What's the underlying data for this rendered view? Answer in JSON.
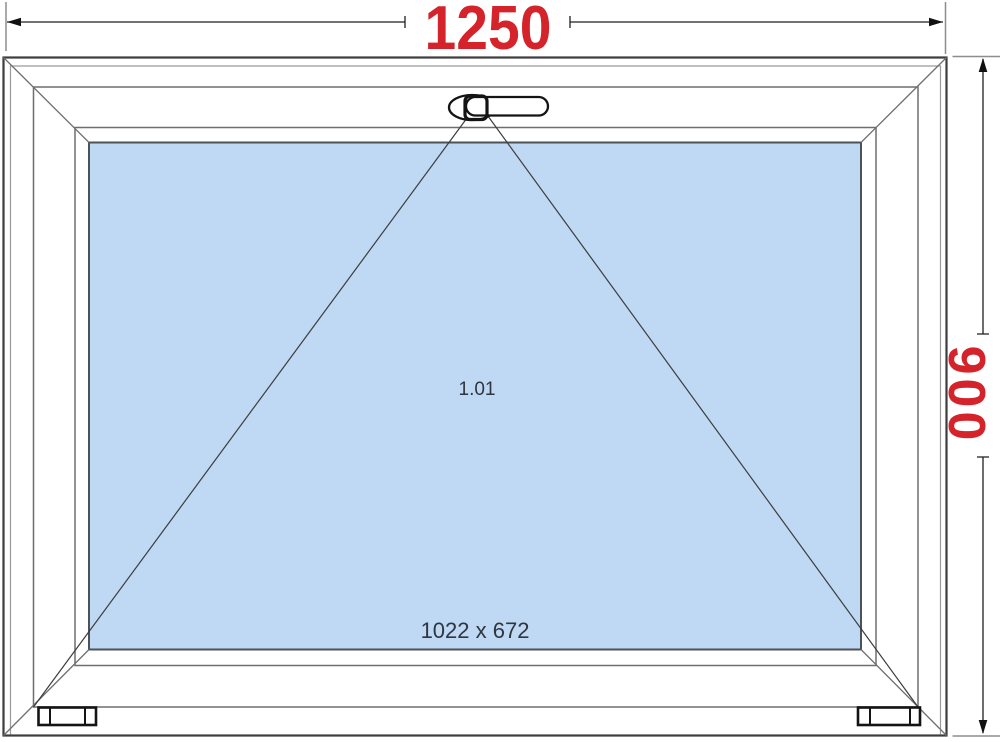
{
  "diagram": {
    "kind": "window-technical-drawing",
    "opening_symbol": "tilt-opening-triangle",
    "handle_icon": "window-handle"
  },
  "dimensions": {
    "width": "1250",
    "height": "900"
  },
  "labels": {
    "position": "1.01",
    "glazing_size": "1022 x 672"
  },
  "colors": {
    "dimension_text": "#d5232b",
    "glass_fill": "#bfd8f3",
    "glass_stroke": "#4d5257",
    "frame_outer_stroke": "#3d3d3d",
    "frame_line": "#6e6e6e",
    "dimension_line": "#1f1f1f",
    "extension_line": "#8d8d8d",
    "handle_stroke": "#141414",
    "label_text": "#2e3640"
  }
}
